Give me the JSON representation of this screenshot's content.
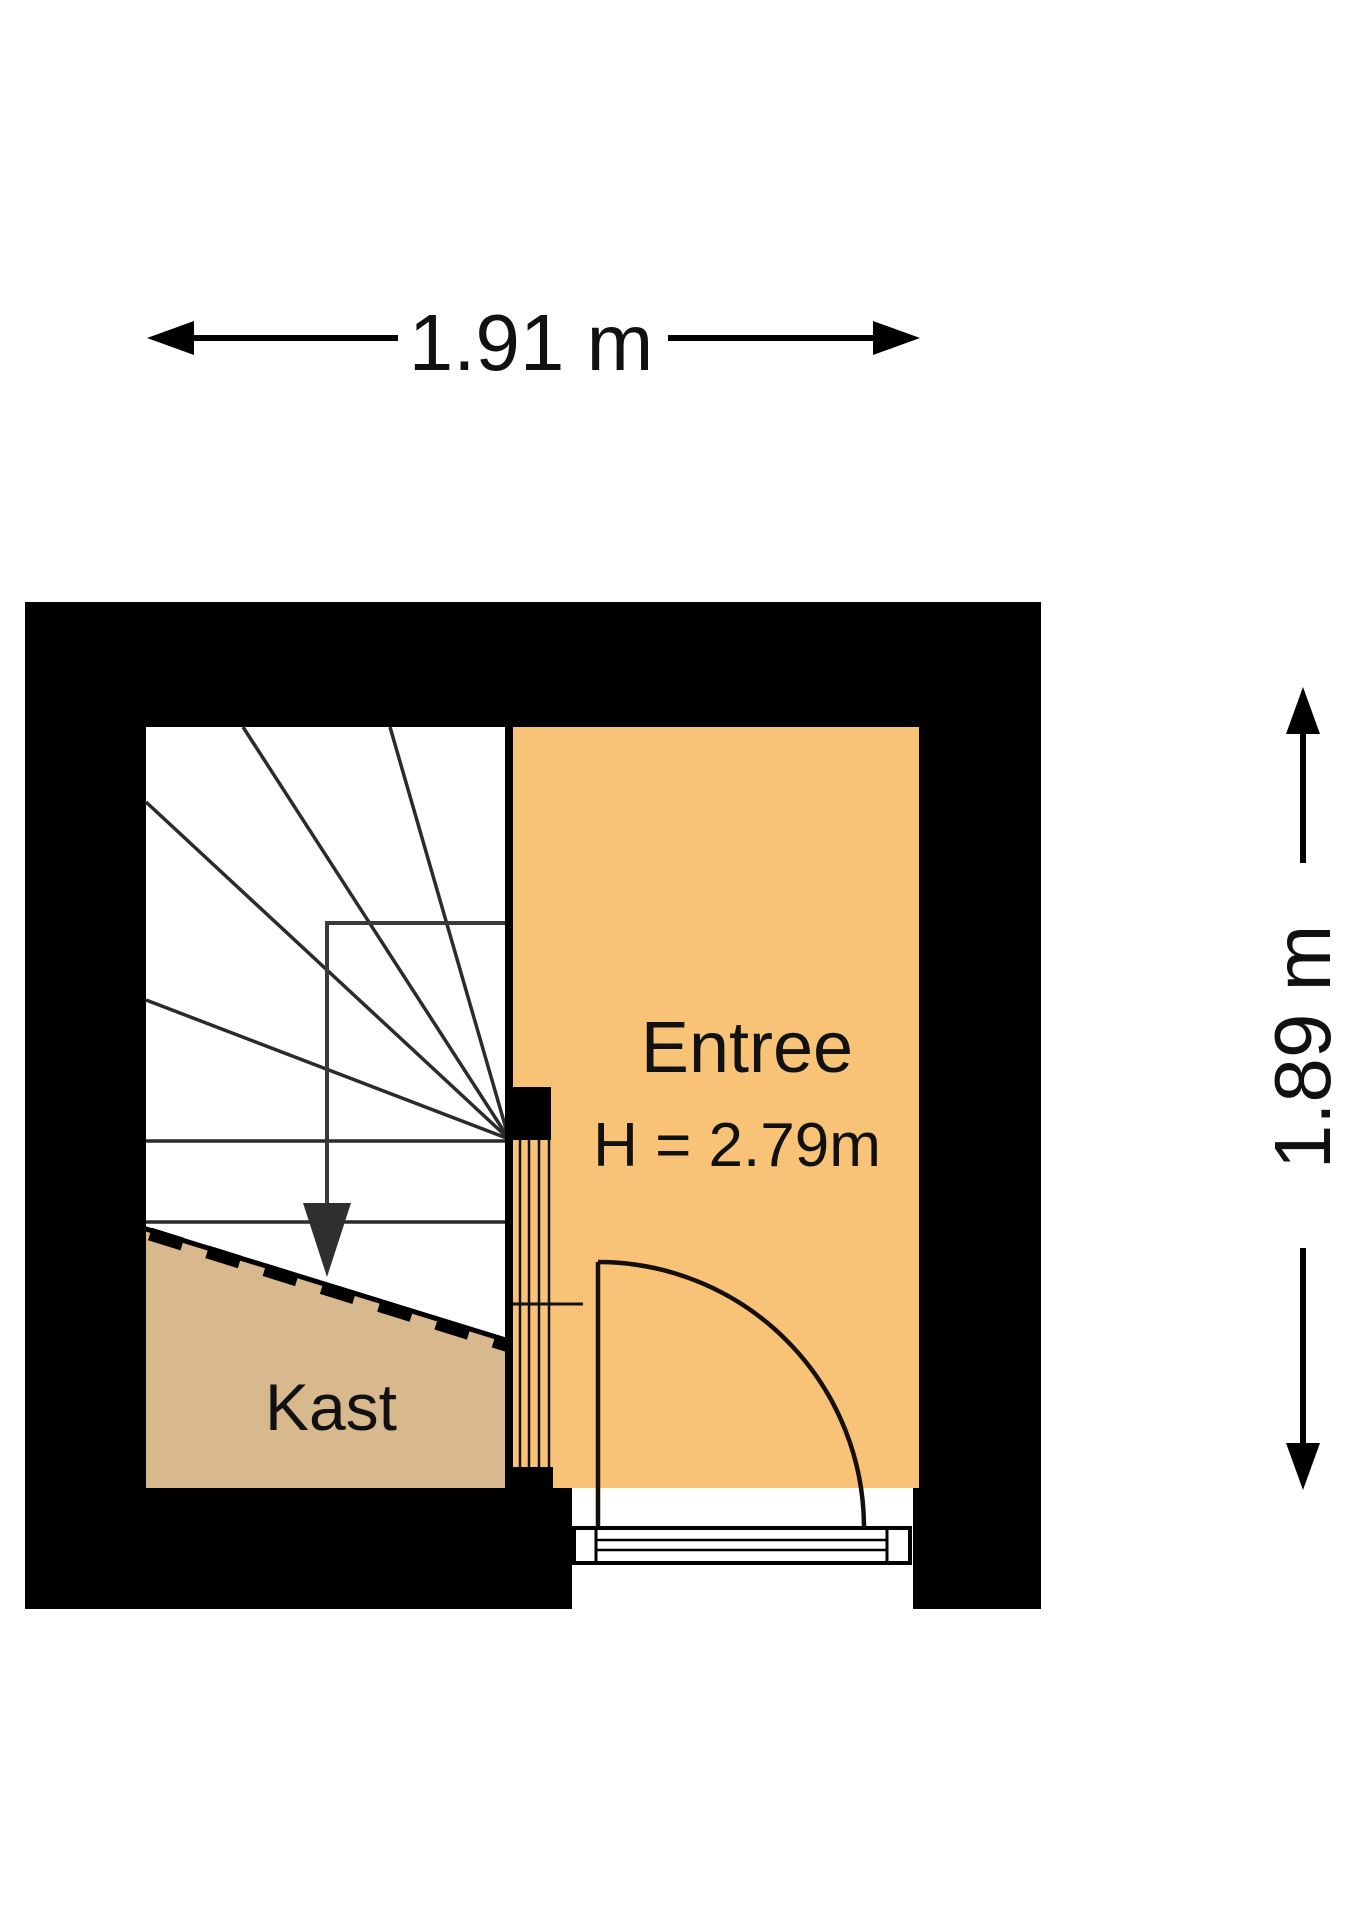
{
  "floorplan": {
    "dimensions": {
      "width_label": "1.91 m",
      "height_label": "1.89 m"
    },
    "rooms": [
      {
        "name": "Entree",
        "height_label": "H = 2.79m",
        "fill": "#F8C377"
      },
      {
        "name": "Kast",
        "fill": "#D8B98D"
      }
    ],
    "colors": {
      "wall": "#000000",
      "interior": "#ffffff",
      "stair_line": "#2b2b2b",
      "walk_line": "#3a3a3a",
      "door_line": "#140f0a",
      "dimension": "#000000"
    }
  }
}
